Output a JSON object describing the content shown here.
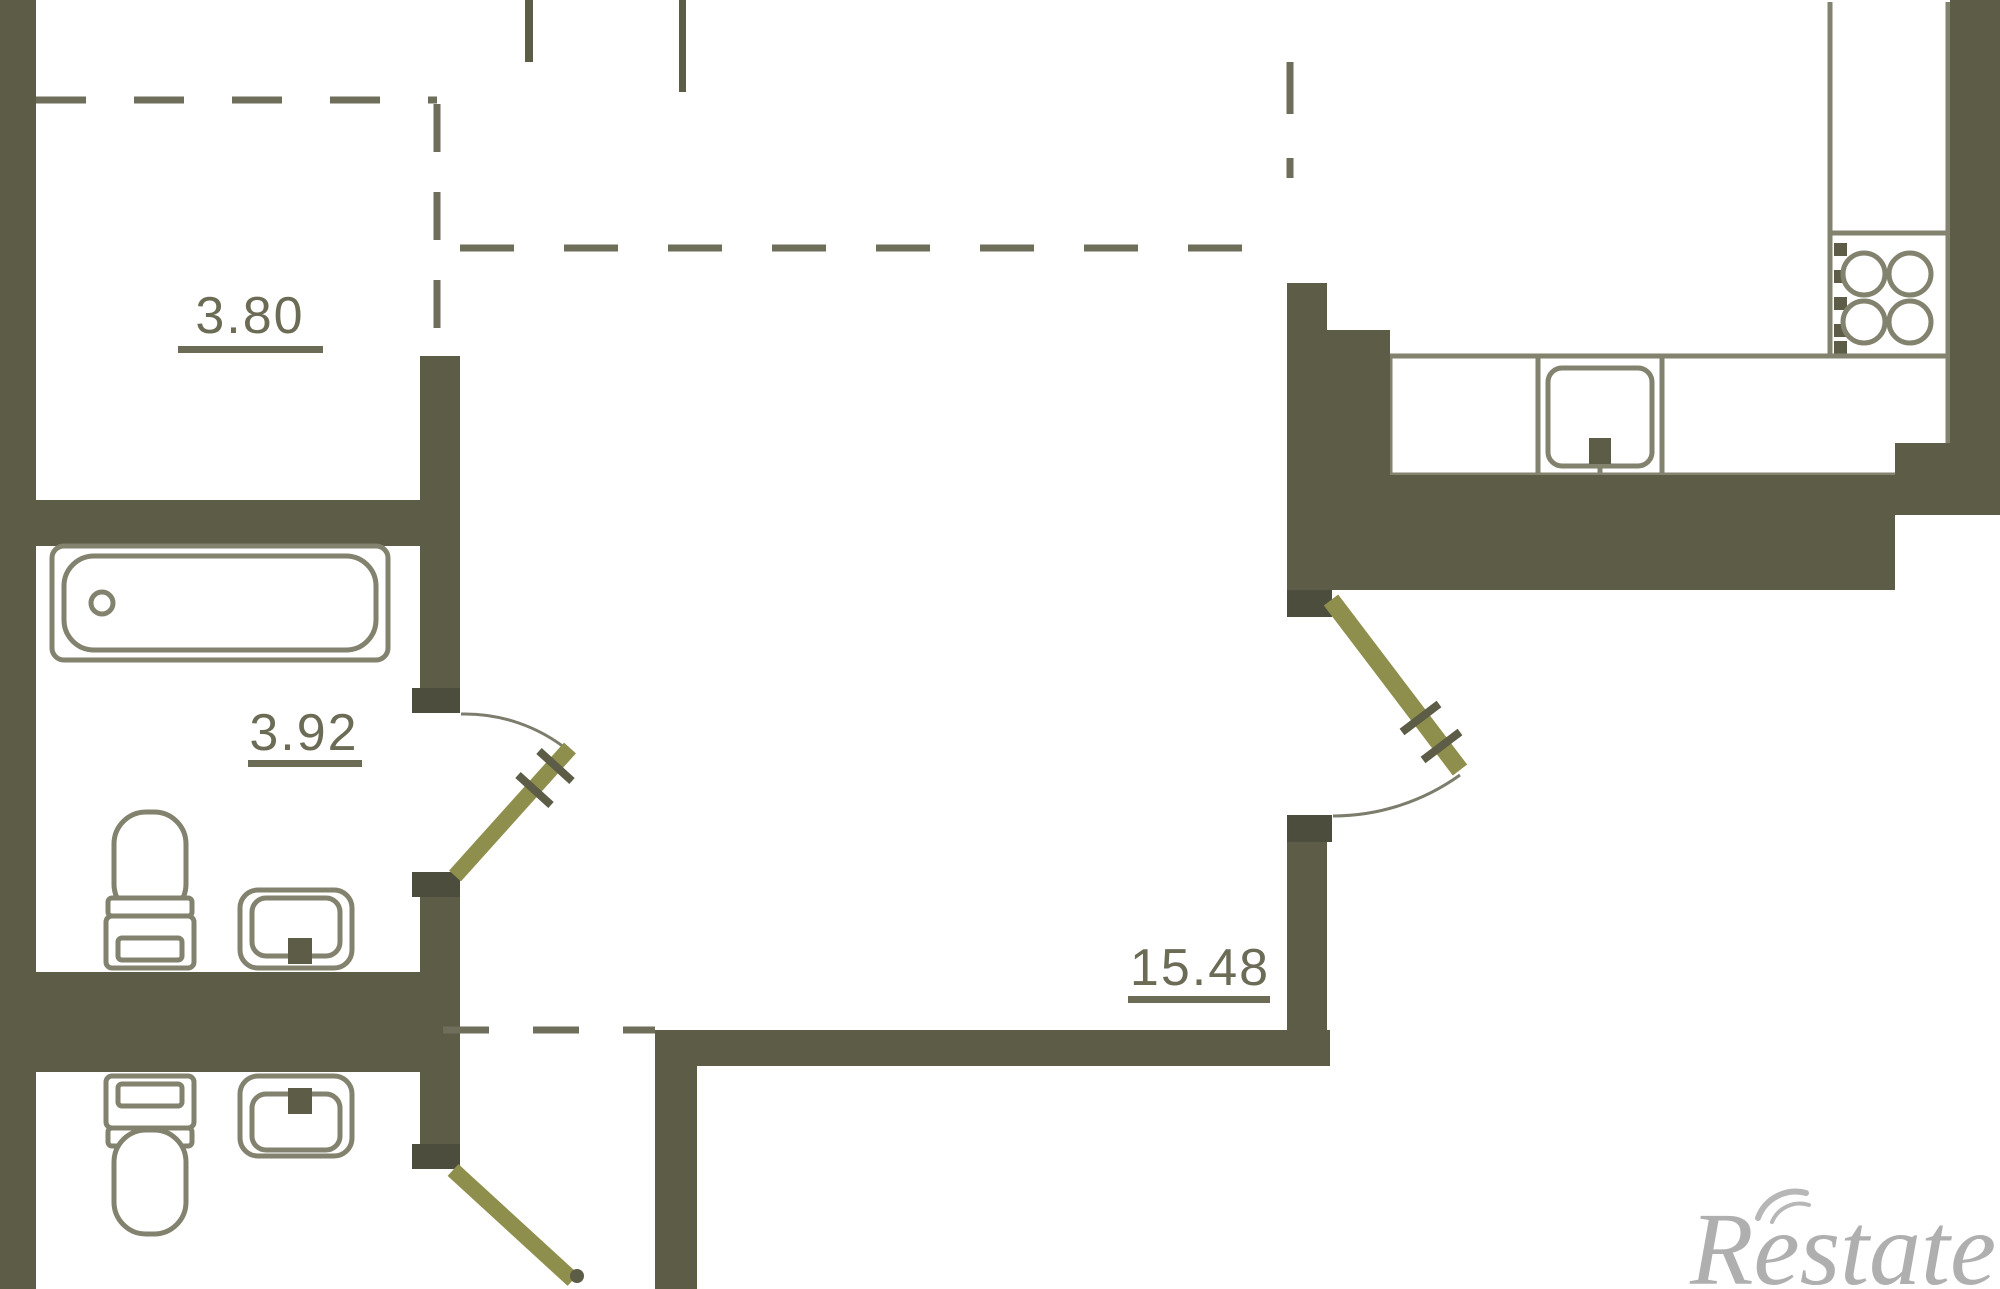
{
  "colors": {
    "wall": "#5c5c47",
    "jamb": "#4d4d3d",
    "door": "#8f8f4d",
    "dash": "#6e6e5b",
    "fixture": "#82826e",
    "arc": "#7d7d6d",
    "label": "#6b6b56",
    "watermark": "#6f6f6f",
    "bg": "#ffffff"
  },
  "plan": {
    "type": "apartment-floor-plan",
    "rooms": [
      {
        "name": "storage-closet",
        "area": "3.80"
      },
      {
        "name": "bathroom",
        "area": "3.92"
      },
      {
        "name": "hallway-living",
        "area": "15.48"
      }
    ],
    "fixtures": [
      "bathtub",
      "toilet",
      "sink",
      "toilet",
      "sink",
      "kitchen-counter",
      "stove-4-burners",
      "kitchen-sink"
    ],
    "door_count": 3
  },
  "watermark": {
    "text": "Restate"
  }
}
